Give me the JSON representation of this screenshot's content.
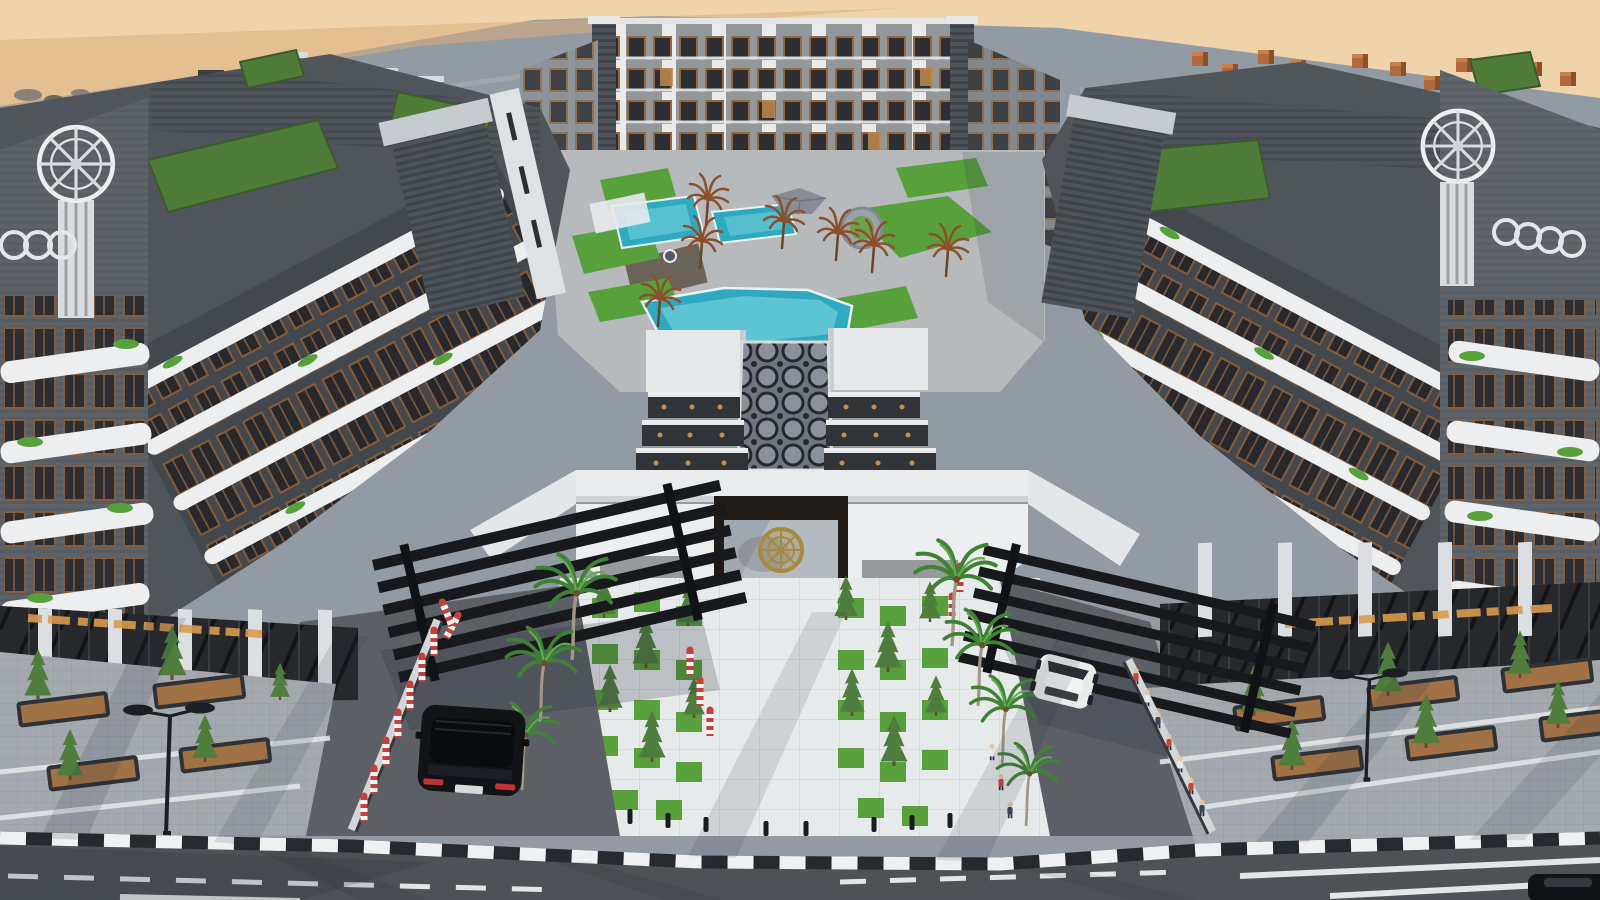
{
  "meta": {
    "description": "Aerial 3D architectural rendering of a modern U-shaped residential apartment complex in a desert setting, with landscaped courtyard, swimming pools, grand entrance gate, palm-lined driveways and a street in the foreground",
    "view": "high aerial three-quarter view",
    "time_of_day": "late afternoon with long diagonal shadows"
  },
  "colors": {
    "sand_light": "#eed3ab",
    "sand_deep": "#dcae7e",
    "roof_gray": "#929aa4",
    "facade_dark": "#50555c",
    "facade_darker": "#43474e",
    "facade_mid": "#6a6f76",
    "white_trim": "#eceeef",
    "wood_accent": "#8a5c36",
    "window_glass": "#26282d",
    "green_roof": "#4e7c38",
    "lawn_green": "#58a03c",
    "conifer_green": "#4f7d3e",
    "palm_green": "#3f8236",
    "palm_brown": "#8d4e2a",
    "pool_water": "#2fa9bf",
    "pool_water_light": "#74d2dc",
    "courtyard_pave": "#b6babd",
    "plaza_tile": "#e7eaea",
    "tile_joint": "#d2d6d6",
    "paver_gray": "#a4a9af",
    "driveway_gray": "#5c6066",
    "asphalt": "#4e5156",
    "curb_black": "#26292d",
    "curb_white": "#eef0f1",
    "road_marking": "#e3e6e6",
    "canopy_black": "#17191d",
    "amber_glow": "#d99a4e",
    "gold_emblem": "#a8893f",
    "car_black": "#121317",
    "car_white": "#e9eaea",
    "bollard_red": "#c4403a",
    "planter_soil": "#a07246",
    "shadow_blue": "#232b3a"
  },
  "scene": {
    "setting": "desert site, sand visible beyond the perimeter roofline",
    "buildings": {
      "shape": "U-shaped perimeter block, five to six storeys",
      "materials": "charcoal ribbed cladding, white curved balcony bands, wood-toned window frames",
      "roof": "continuous gray roof plane with green roof-garden patches, stair bulkheads and brick chimneys",
      "corner_towers": "two corner pylons crowned with white helm-wheel emblems, vertical fins and interlocked-ring motifs"
    },
    "courtyard": {
      "features": [
        "three turquoise swimming pools",
        "lawn patches",
        "dried ornamental brown palms",
        "gray parasol",
        "round planter island",
        "timber deck"
      ]
    },
    "entrance": {
      "features": [
        "hexagonal-glass skylight walkway",
        "stepped dark glass skylights with amber lights",
        "white cantilevered roof band",
        "dark gate portal with gold helm emblem on glass",
        "angular white canopy wings",
        "stone side blocks with windows"
      ]
    },
    "foreground": {
      "features": [
        "checkerboard lawn-and-tile plaza with conifers",
        "black bollards",
        "two driveways under louvered black canopies",
        "red-white striped bollards",
        "pedestrians along driveway wall",
        "palm trees",
        "sidewalks with parking planters and conifers",
        "double-head street lamps",
        "black-and-white striped curb",
        "asphalt road with white lane markings",
        "illegible illuminated signage glow on storefronts"
      ]
    },
    "vehicles": [
      "black SUV entering left driveway",
      "white crossover exiting right driveway",
      "dark parked car partially visible bottom-right"
    ]
  }
}
